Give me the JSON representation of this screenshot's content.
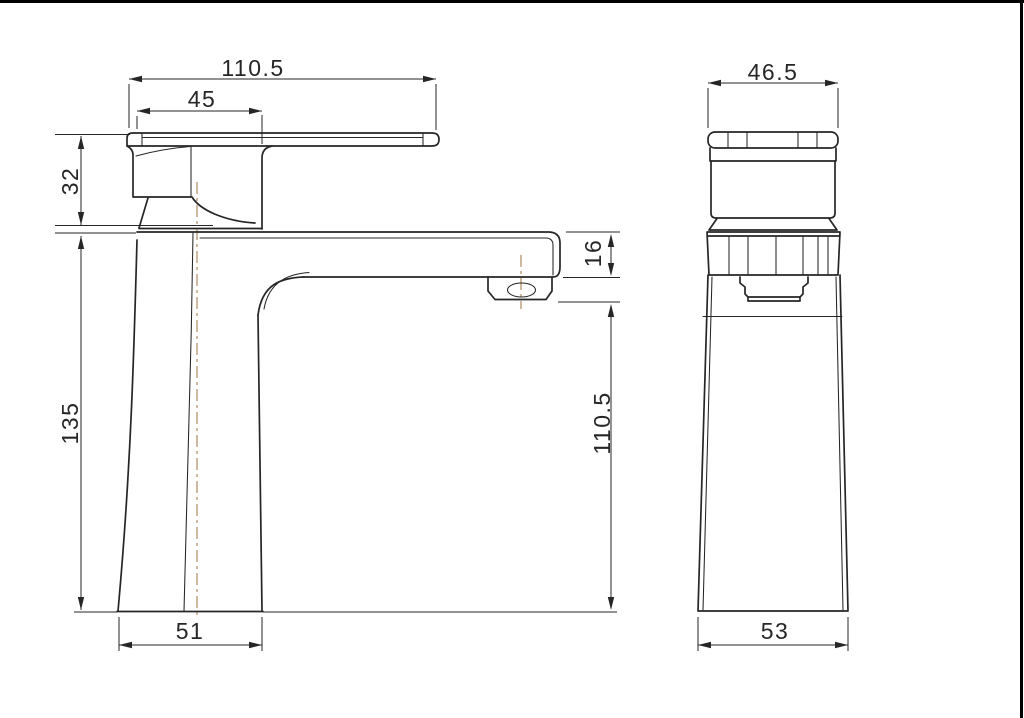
{
  "drawing": {
    "kind": "technical-drawing",
    "subject": "single-lever basin faucet, two orthographic views with dimensions"
  },
  "dims": {
    "front_overall_width": "110.5",
    "front_handle_width": "45",
    "front_handle_height": "32",
    "front_body_height": "135",
    "front_spout_thickness": "16",
    "front_spout_to_base": "110.5",
    "front_base_width": "51",
    "side_overall_width": "46.5",
    "side_base_width": "53"
  },
  "colors": {
    "line_color": "#262626",
    "centerline_color": "#ad8b60",
    "background": "#ffffff",
    "frame_color": "#000000"
  }
}
